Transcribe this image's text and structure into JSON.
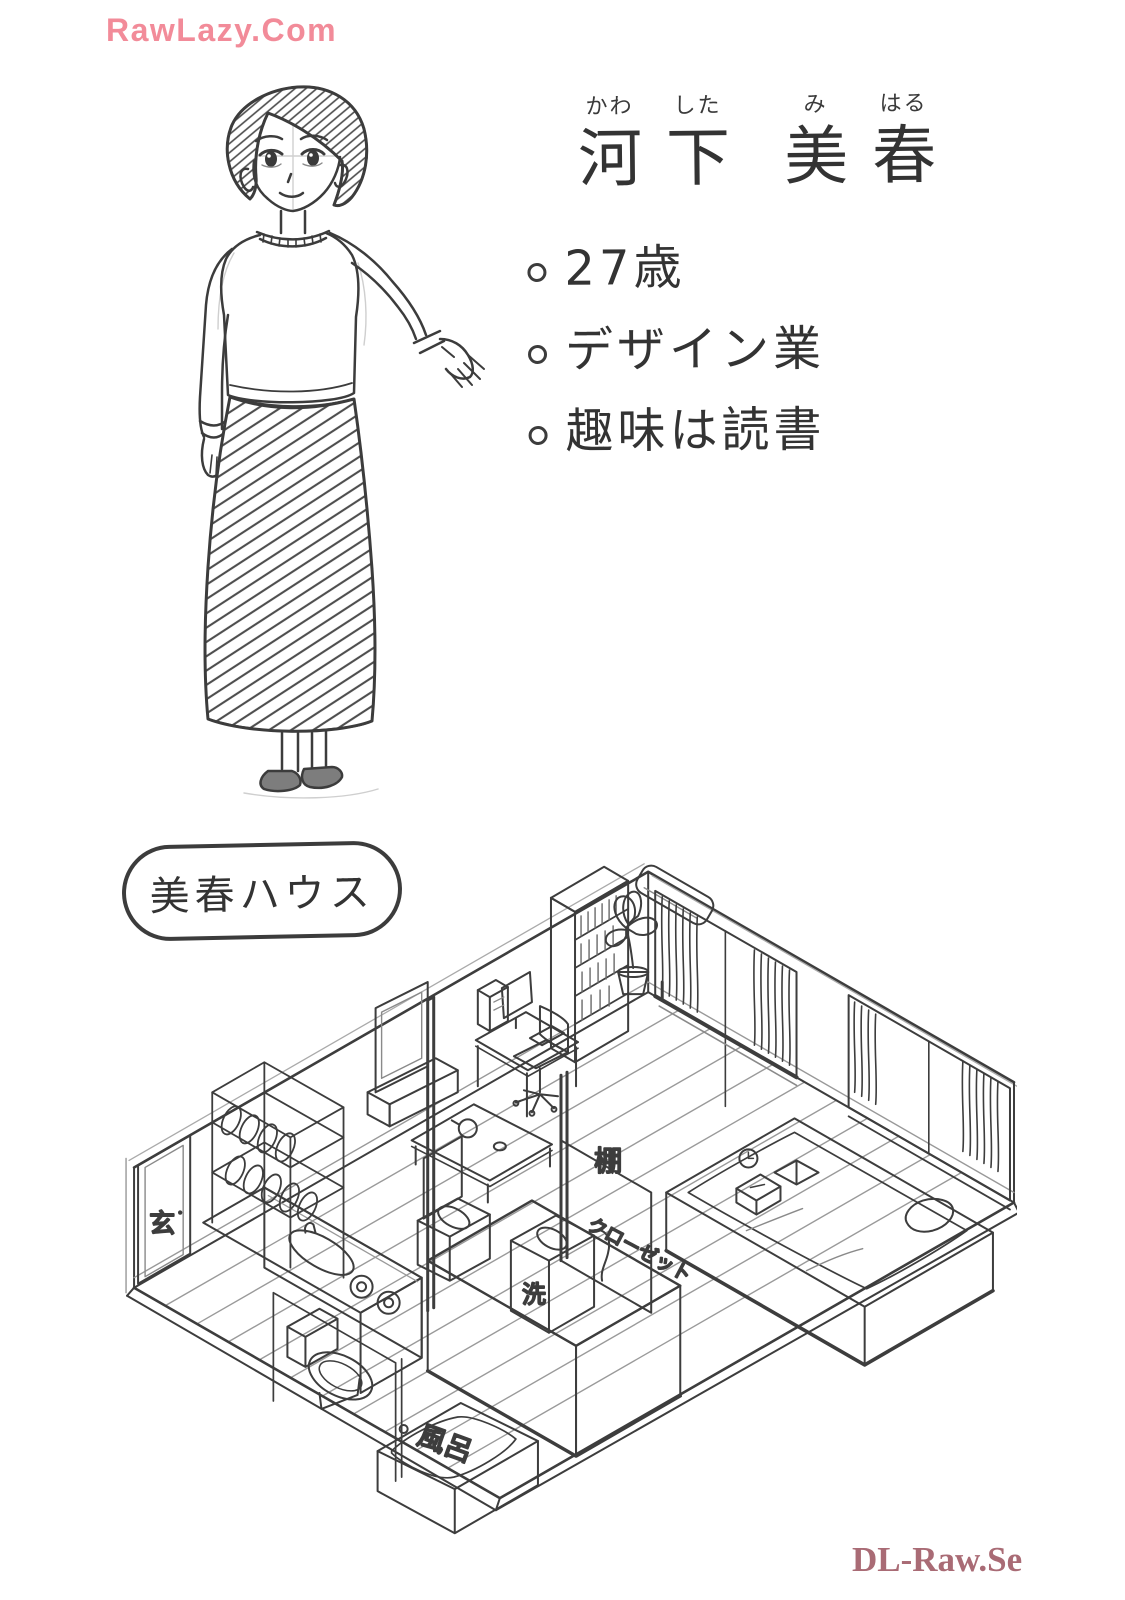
{
  "page": {
    "watermark_top": "RawLazy.Com",
    "watermark_bottom": "DL-Raw.Se",
    "colors": {
      "watermark_top_pink": "#F28B99",
      "watermark_bottom_mauve": "#A96B75",
      "ink": "#3C3C3C",
      "paper": "#FFFFFF",
      "pencil_gray": "#C9C9C9"
    }
  },
  "character": {
    "name_chars": [
      {
        "kanji": "河",
        "kana": "かわ"
      },
      {
        "kanji": "下",
        "kana": "した"
      },
      {
        "kanji": "美",
        "kana": "み"
      },
      {
        "kanji": "春",
        "kana": "はる"
      }
    ],
    "bullet_icon": "small-circle",
    "profile": [
      "27歳",
      "デザイン業",
      "趣味は読書"
    ]
  },
  "house": {
    "label": "美春ハウス",
    "room_labels": {
      "entrance": "玄",
      "shelf": "棚",
      "closet": "クローゼット",
      "washer": "洗",
      "bath": "風呂"
    }
  }
}
